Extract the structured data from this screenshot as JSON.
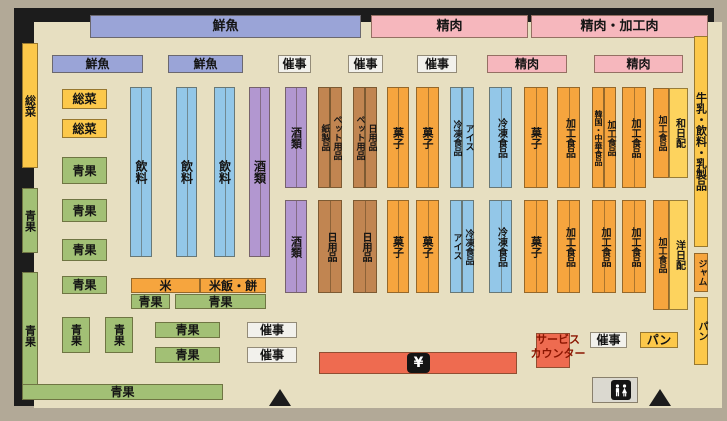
{
  "title": "supermarket-floor-plan",
  "colors": {
    "floor": "#e7dfc1",
    "outer": "#b2a997",
    "wall": "#1c1c1c",
    "blue_banner": "#9aa4d7",
    "pink": "#f6b7bd",
    "yellow": "#fcc84a",
    "yellow_light": "#fdd35e",
    "green": "#a2c075",
    "blue": "#93c7e8",
    "purple": "#b297d0",
    "brown": "#c18551",
    "orange": "#f6a53e",
    "red": "#ee6b50",
    "white_box": "#f2f1ec",
    "gray_box": "#dbd9d0"
  },
  "checkout": {
    "symbol": "¥"
  },
  "service_counter": {
    "label": "サービス\nカウンター"
  },
  "boxes": [
    {
      "name": "banner-fresh-fish",
      "label": "鮮魚",
      "x": 90,
      "y": 15,
      "w": 271,
      "h": 23,
      "c": "blue_banner",
      "fs": 13
    },
    {
      "name": "banner-meat",
      "label": "精肉",
      "x": 371,
      "y": 15,
      "w": 157,
      "h": 23,
      "c": "pink",
      "fs": 13
    },
    {
      "name": "banner-meat-processed-meat",
      "label": "精肉・加工肉",
      "x": 531,
      "y": 15,
      "w": 177,
      "h": 23,
      "c": "pink",
      "fs": 13
    },
    {
      "name": "shelf-fresh-fish-1",
      "label": "鮮魚",
      "x": 52,
      "y": 55,
      "w": 91,
      "h": 18,
      "c": "blue_banner"
    },
    {
      "name": "shelf-fresh-fish-2",
      "label": "鮮魚",
      "x": 168,
      "y": 55,
      "w": 75,
      "h": 18,
      "c": "blue_banner"
    },
    {
      "name": "shelf-event-1",
      "label": "催事",
      "x": 278,
      "y": 55,
      "w": 33,
      "h": 18,
      "c": "white_box"
    },
    {
      "name": "shelf-event-2",
      "label": "催事",
      "x": 348,
      "y": 55,
      "w": 35,
      "h": 18,
      "c": "white_box"
    },
    {
      "name": "shelf-event-3",
      "label": "催事",
      "x": 417,
      "y": 55,
      "w": 40,
      "h": 18,
      "c": "white_box"
    },
    {
      "name": "shelf-meat-1",
      "label": "精肉",
      "x": 487,
      "y": 55,
      "w": 80,
      "h": 18,
      "c": "pink"
    },
    {
      "name": "shelf-meat-2",
      "label": "精肉",
      "x": 594,
      "y": 55,
      "w": 89,
      "h": 18,
      "c": "pink"
    },
    {
      "name": "wall-deli",
      "label": "総菜",
      "x": 22,
      "y": 43,
      "w": 16,
      "h": 125,
      "c": "yellow",
      "v": 1,
      "fs": 11
    },
    {
      "name": "wall-produce-upper",
      "label": "青果",
      "x": 22,
      "y": 188,
      "w": 16,
      "h": 65,
      "c": "green",
      "v": 1,
      "fs": 11
    },
    {
      "name": "wall-produce-lower",
      "label": "青果",
      "x": 22,
      "y": 272,
      "w": 16,
      "h": 128,
      "c": "green",
      "v": 1,
      "fs": 11
    },
    {
      "name": "produce-bottom-bar",
      "label": "青果",
      "x": 22,
      "y": 384,
      "w": 201,
      "h": 16,
      "c": "green"
    },
    {
      "name": "shelf-deli-1",
      "label": "総菜",
      "x": 62,
      "y": 89,
      "w": 45,
      "h": 20,
      "c": "yellow"
    },
    {
      "name": "shelf-deli-2",
      "label": "総菜",
      "x": 62,
      "y": 119,
      "w": 45,
      "h": 19,
      "c": "yellow"
    },
    {
      "name": "shelf-produce-1",
      "label": "青果",
      "x": 62,
      "y": 157,
      "w": 45,
      "h": 27,
      "c": "green"
    },
    {
      "name": "shelf-produce-2",
      "label": "青果",
      "x": 62,
      "y": 199,
      "w": 45,
      "h": 23,
      "c": "green"
    },
    {
      "name": "shelf-produce-3",
      "label": "青果",
      "x": 62,
      "y": 239,
      "w": 45,
      "h": 22,
      "c": "green"
    },
    {
      "name": "shelf-produce-4",
      "label": "青果",
      "x": 62,
      "y": 276,
      "w": 45,
      "h": 18,
      "c": "green"
    },
    {
      "name": "shelf-produce-5",
      "label": "青果",
      "x": 62,
      "y": 317,
      "w": 28,
      "h": 36,
      "c": "green",
      "v": 1,
      "fs": 11
    },
    {
      "name": "shelf-produce-6",
      "label": "青果",
      "x": 105,
      "y": 317,
      "w": 28,
      "h": 36,
      "c": "green",
      "v": 1,
      "fs": 11
    },
    {
      "name": "shelf-rice",
      "label": "米",
      "x": 131,
      "y": 278,
      "w": 69,
      "h": 15,
      "c": "orange"
    },
    {
      "name": "shelf-rice-mochi",
      "label": "米飯・餅",
      "x": 200,
      "y": 278,
      "w": 66,
      "h": 15,
      "c": "orange"
    },
    {
      "name": "shelf-produce-7",
      "label": "青果",
      "x": 131,
      "y": 294,
      "w": 39,
      "h": 15,
      "c": "green"
    },
    {
      "name": "shelf-produce-8",
      "label": "青果",
      "x": 175,
      "y": 294,
      "w": 91,
      "h": 15,
      "c": "green"
    },
    {
      "name": "shelf-produce-9",
      "label": "青果",
      "x": 155,
      "y": 322,
      "w": 65,
      "h": 16,
      "c": "green"
    },
    {
      "name": "shelf-produce-10",
      "label": "青果",
      "x": 155,
      "y": 347,
      "w": 65,
      "h": 16,
      "c": "green"
    },
    {
      "name": "shelf-event-4",
      "label": "催事",
      "x": 247,
      "y": 322,
      "w": 50,
      "h": 16,
      "c": "white_box"
    },
    {
      "name": "shelf-event-5",
      "label": "催事",
      "x": 247,
      "y": 347,
      "w": 50,
      "h": 16,
      "c": "white_box"
    },
    {
      "name": "aisle-beverage-1",
      "label": "飲料",
      "x": 130,
      "y": 87,
      "w": 22,
      "h": 170,
      "c": "blue",
      "v": 1,
      "dv": 1
    },
    {
      "name": "aisle-beverage-2",
      "label": "飲料",
      "x": 176,
      "y": 87,
      "w": 21,
      "h": 170,
      "c": "blue",
      "v": 1,
      "dv": 1
    },
    {
      "name": "aisle-beverage-3",
      "label": "飲料",
      "x": 214,
      "y": 87,
      "w": 21,
      "h": 170,
      "c": "blue",
      "v": 1,
      "dv": 1
    },
    {
      "name": "aisle-liquor-1",
      "label": "酒類",
      "x": 249,
      "y": 87,
      "w": 21,
      "h": 170,
      "c": "purple",
      "v": 1,
      "dv": 1
    },
    {
      "name": "aisle-liquor-2-upper",
      "label": "酒類",
      "x": 285,
      "y": 87,
      "w": 22,
      "h": 101,
      "c": "purple",
      "v": 1,
      "dv": 1,
      "fs": 11
    },
    {
      "name": "aisle-liquor-2-lower",
      "label": "酒類",
      "x": 285,
      "y": 200,
      "w": 22,
      "h": 93,
      "c": "purple",
      "v": 1,
      "dv": 1,
      "fs": 11
    },
    {
      "name": "aisle-paper-products",
      "label": "紙製品",
      "x": 318,
      "y": 87,
      "w": 12,
      "h": 101,
      "c": "brown",
      "v": 1,
      "fs": 9
    },
    {
      "name": "aisle-pet-supplies-1",
      "label": "ペット用品",
      "x": 330,
      "y": 87,
      "w": 12,
      "h": 101,
      "c": "brown",
      "v": 1,
      "fs": 9
    },
    {
      "name": "aisle-daily-goods-1-lower",
      "label": "日用品",
      "x": 318,
      "y": 200,
      "w": 24,
      "h": 93,
      "c": "brown",
      "v": 1,
      "dv": 1,
      "fs": 10
    },
    {
      "name": "aisle-pet-supplies-2",
      "label": "ペット用品",
      "x": 353,
      "y": 87,
      "w": 12,
      "h": 101,
      "c": "brown",
      "v": 1,
      "fs": 9
    },
    {
      "name": "aisle-daily-goods-2-upper",
      "label": "日用品",
      "x": 365,
      "y": 87,
      "w": 12,
      "h": 101,
      "c": "brown",
      "v": 1,
      "fs": 9
    },
    {
      "name": "aisle-daily-goods-2-lower",
      "label": "日用品",
      "x": 353,
      "y": 200,
      "w": 24,
      "h": 93,
      "c": "brown",
      "v": 1,
      "dv": 1,
      "fs": 10
    },
    {
      "name": "aisle-snacks-1-upper",
      "label": "菓子",
      "x": 387,
      "y": 87,
      "w": 22,
      "h": 101,
      "c": "orange",
      "v": 1,
      "dv": 1,
      "fs": 11
    },
    {
      "name": "aisle-snacks-1-lower",
      "label": "菓子",
      "x": 387,
      "y": 200,
      "w": 22,
      "h": 93,
      "c": "orange",
      "v": 1,
      "dv": 1,
      "fs": 11
    },
    {
      "name": "aisle-snacks-2-upper",
      "label": "菓子",
      "x": 416,
      "y": 87,
      "w": 23,
      "h": 101,
      "c": "orange",
      "v": 1,
      "dv": 1,
      "fs": 11
    },
    {
      "name": "aisle-snacks-2-lower",
      "label": "菓子",
      "x": 416,
      "y": 200,
      "w": 23,
      "h": 93,
      "c": "orange",
      "v": 1,
      "dv": 1,
      "fs": 11
    },
    {
      "name": "aisle-frozen-food-1",
      "label": "冷凍食品",
      "x": 450,
      "y": 87,
      "w": 12,
      "h": 101,
      "c": "blue",
      "v": 1,
      "fs": 9
    },
    {
      "name": "aisle-ice-cream-1",
      "label": "アイス",
      "x": 462,
      "y": 87,
      "w": 12,
      "h": 101,
      "c": "blue",
      "v": 1,
      "fs": 9
    },
    {
      "name": "aisle-ice-cream-2",
      "label": "アイス",
      "x": 450,
      "y": 200,
      "w": 12,
      "h": 93,
      "c": "blue",
      "v": 1,
      "fs": 9
    },
    {
      "name": "aisle-frozen-food-2",
      "label": "冷凍食品",
      "x": 462,
      "y": 200,
      "w": 12,
      "h": 93,
      "c": "blue",
      "v": 1,
      "fs": 9
    },
    {
      "name": "aisle-frozen-food-3",
      "label": "冷凍食品",
      "x": 489,
      "y": 87,
      "w": 23,
      "h": 101,
      "c": "blue",
      "v": 1,
      "dv": 1,
      "fs": 10
    },
    {
      "name": "aisle-frozen-food-4",
      "label": "冷凍食品",
      "x": 489,
      "y": 200,
      "w": 23,
      "h": 93,
      "c": "blue",
      "v": 1,
      "dv": 1,
      "fs": 10
    },
    {
      "name": "aisle-snacks-3-upper",
      "label": "菓子",
      "x": 524,
      "y": 87,
      "w": 24,
      "h": 101,
      "c": "orange",
      "v": 1,
      "dv": 1,
      "fs": 11
    },
    {
      "name": "aisle-snacks-3-lower",
      "label": "菓子",
      "x": 524,
      "y": 200,
      "w": 24,
      "h": 93,
      "c": "orange",
      "v": 1,
      "dv": 1,
      "fs": 11
    },
    {
      "name": "aisle-processed-food-1-upper",
      "label": "加工食品",
      "x": 557,
      "y": 87,
      "w": 23,
      "h": 101,
      "c": "orange",
      "v": 1,
      "dv": 1,
      "fs": 10
    },
    {
      "name": "aisle-processed-food-1-lower",
      "label": "加工食品",
      "x": 557,
      "y": 200,
      "w": 23,
      "h": 93,
      "c": "orange",
      "v": 1,
      "dv": 1,
      "fs": 10
    },
    {
      "name": "aisle-korean-chinese-food",
      "label": "韓国・中華食品",
      "x": 592,
      "y": 87,
      "w": 12,
      "h": 101,
      "c": "orange",
      "v": 1,
      "fs": 8
    },
    {
      "name": "aisle-processed-food-2-upper",
      "label": "加工食品",
      "x": 604,
      "y": 87,
      "w": 12,
      "h": 101,
      "c": "orange",
      "v": 1,
      "fs": 9
    },
    {
      "name": "aisle-processed-food-2-lower",
      "label": "加工食品",
      "x": 592,
      "y": 200,
      "w": 24,
      "h": 93,
      "c": "orange",
      "v": 1,
      "dv": 1,
      "fs": 10
    },
    {
      "name": "aisle-processed-food-3-upper",
      "label": "加工食品",
      "x": 622,
      "y": 87,
      "w": 24,
      "h": 101,
      "c": "orange",
      "v": 1,
      "dv": 1,
      "fs": 10
    },
    {
      "name": "aisle-processed-food-3-lower",
      "label": "加工食品",
      "x": 622,
      "y": 200,
      "w": 24,
      "h": 93,
      "c": "orange",
      "v": 1,
      "dv": 1,
      "fs": 10
    },
    {
      "name": "aisle-processed-food-4-upper",
      "label": "加工食品",
      "x": 653,
      "y": 88,
      "w": 16,
      "h": 90,
      "c": "orange",
      "v": 1,
      "fs": 9
    },
    {
      "name": "aisle-japanese-daily-delivery",
      "label": "和日配",
      "x": 669,
      "y": 88,
      "w": 19,
      "h": 90,
      "c": "yellow_light",
      "v": 1,
      "fs": 10
    },
    {
      "name": "aisle-processed-food-4-lower",
      "label": "加工食品",
      "x": 653,
      "y": 200,
      "w": 16,
      "h": 110,
      "c": "orange",
      "v": 1,
      "fs": 9
    },
    {
      "name": "aisle-western-daily-delivery",
      "label": "洋日配",
      "x": 669,
      "y": 200,
      "w": 19,
      "h": 110,
      "c": "yellow_light",
      "v": 1,
      "fs": 10
    },
    {
      "name": "wall-milk-beverage-dairy",
      "label": "牛乳・飲料・乳製品",
      "x": 694,
      "y": 36,
      "w": 14,
      "h": 211,
      "c": "yellow",
      "v": 1,
      "fs": 11
    },
    {
      "name": "wall-jam",
      "label": "ジャム",
      "x": 694,
      "y": 253,
      "w": 14,
      "h": 39,
      "c": "orange",
      "v": 1,
      "fs": 9
    },
    {
      "name": "wall-bread",
      "label": "パン",
      "x": 694,
      "y": 297,
      "w": 14,
      "h": 68,
      "c": "yellow",
      "v": 1,
      "fs": 10
    },
    {
      "name": "shelf-event-6",
      "label": "催事",
      "x": 590,
      "y": 332,
      "w": 37,
      "h": 16,
      "c": "white_box"
    },
    {
      "name": "shelf-bread",
      "label": "パン",
      "x": 640,
      "y": 332,
      "w": 38,
      "h": 16,
      "c": "yellow"
    },
    {
      "name": "checkout-counter",
      "label": "",
      "x": 319,
      "y": 352,
      "w": 198,
      "h": 22,
      "c": "red"
    },
    {
      "name": "service-counter",
      "label": "",
      "x": 536,
      "y": 333,
      "w": 34,
      "h": 35,
      "c": "red"
    },
    {
      "name": "toilet-area",
      "label": "",
      "x": 592,
      "y": 377,
      "w": 46,
      "h": 26,
      "c": "gray_box"
    }
  ]
}
